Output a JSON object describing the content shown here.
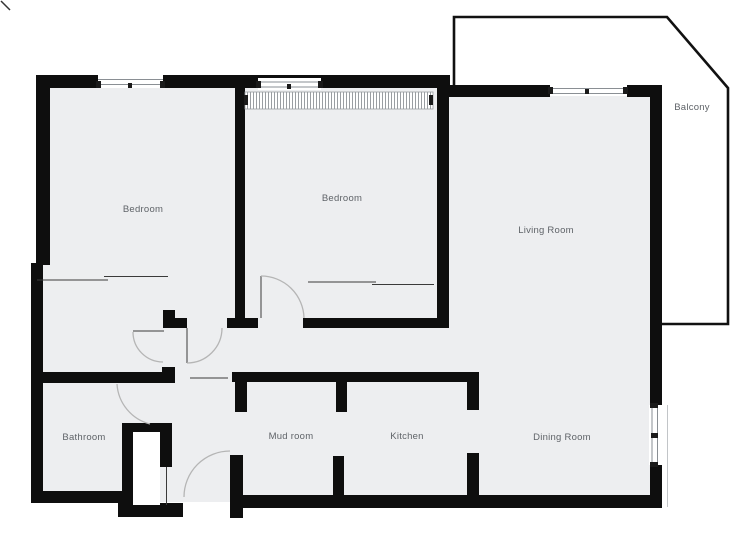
{
  "title": "Apartment floor plan",
  "colors": {
    "floor": "#edeef0",
    "wall": "#0e0e0e",
    "label": "#5f6368",
    "arc": "#b5b5b5",
    "thin": "#3a3a3a",
    "balcony_outline": "#111111"
  },
  "rooms": [
    {
      "id": "bedroom-1",
      "label": "Bedroom"
    },
    {
      "id": "bedroom-2",
      "label": "Bedroom"
    },
    {
      "id": "living-room",
      "label": "Living Room"
    },
    {
      "id": "balcony",
      "label": "Balcony"
    },
    {
      "id": "bathroom",
      "label": "Bathroom"
    },
    {
      "id": "mud-room",
      "label": "Mud room"
    },
    {
      "id": "kitchen",
      "label": "Kitchen"
    },
    {
      "id": "dining-room",
      "label": "Dining Room"
    }
  ]
}
